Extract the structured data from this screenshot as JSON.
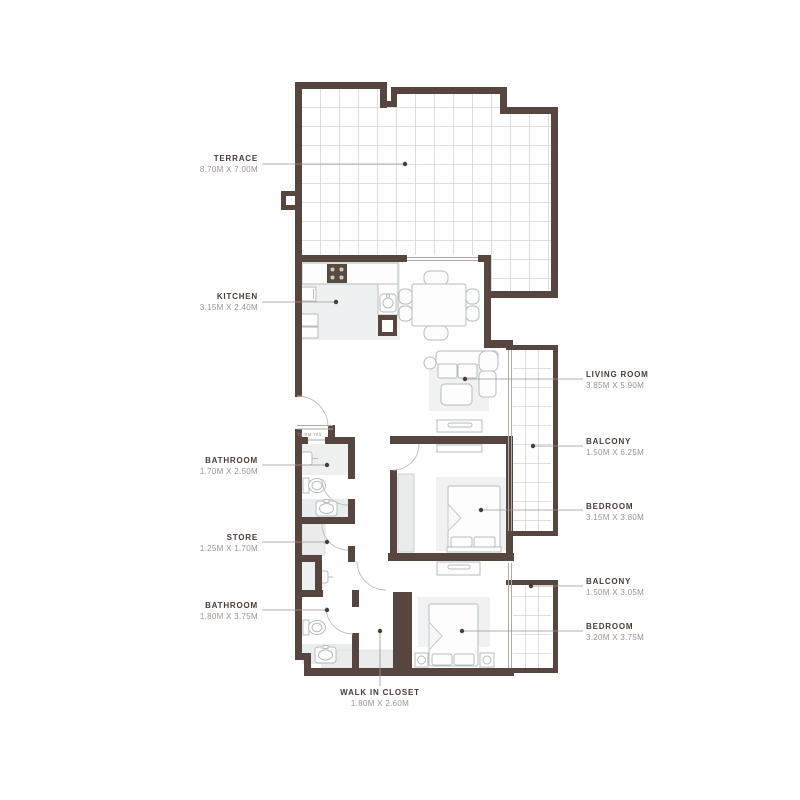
{
  "plan": {
    "unit_label": "T1-RM 703",
    "rooms": [
      {
        "name": "TERRACE",
        "dims": "8.70M X 7.00M"
      },
      {
        "name": "KITCHEN",
        "dims": "3.15M X 2.40M"
      },
      {
        "name": "BATHROOM",
        "dims": "1.70M X 2.50M"
      },
      {
        "name": "STORE",
        "dims": "1.25M X 1.70M"
      },
      {
        "name": "BATHROOM",
        "dims": "1.80M X 3.75M"
      },
      {
        "name": "WALK IN CLOSET",
        "dims": "1.80M X 2.60M"
      },
      {
        "name": "LIVING ROOM",
        "dims": "3.85M X 5.90M"
      },
      {
        "name": "BALCONY",
        "dims": "1.50M X 6.25M"
      },
      {
        "name": "BEDROOM",
        "dims": "3.15M X 3.80M"
      },
      {
        "name": "BALCONY",
        "dims": "1.50M X 3.05M"
      },
      {
        "name": "BEDROOM",
        "dims": "3.20M X 3.75M"
      }
    ],
    "colors": {
      "wall": "#57453f",
      "room_name_text": "#4a3b35",
      "dimension_text": "#9c918c",
      "grid_line": "#ddd3d0",
      "furniture_line": "#b7bdbf",
      "background": "#ffffff"
    }
  }
}
